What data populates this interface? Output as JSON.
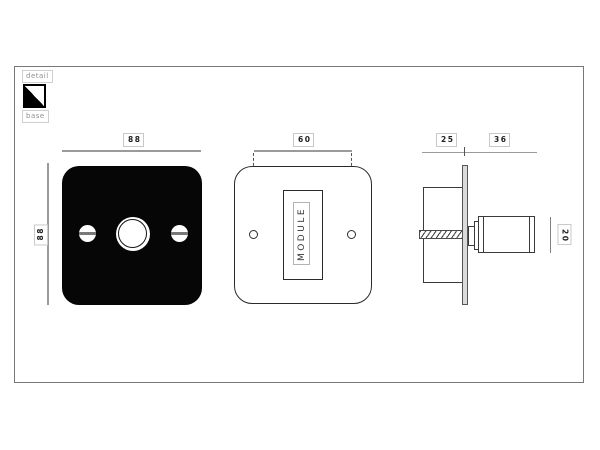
{
  "legend": {
    "detail_label": "detail",
    "base_label": "base"
  },
  "drawing": {
    "front_view_base": {
      "width_dim": "88",
      "height_dim": "88"
    },
    "front_view_module": {
      "hole_spacing_dim": "60",
      "module_label": "MODULE"
    },
    "side_view": {
      "back_depth_dim": "25",
      "front_depth_dim": "36",
      "knob_diameter_dim": "20"
    }
  },
  "colors": {
    "base_plate": "#060606",
    "detail_finish": "#ffffff",
    "line": "#333333",
    "dim_line": "#9a9a9a"
  }
}
